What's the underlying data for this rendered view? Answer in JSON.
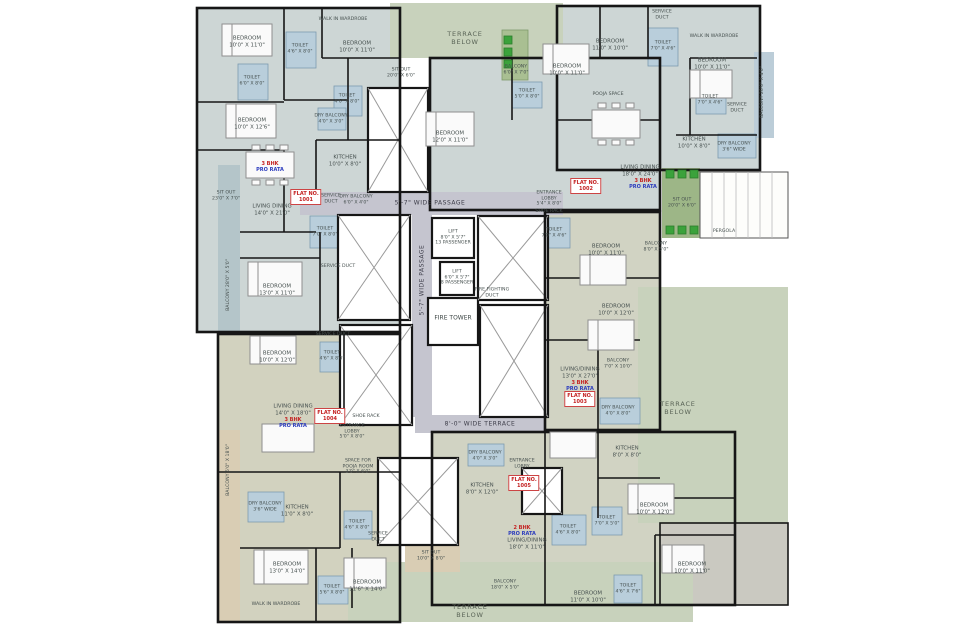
{
  "plan_title": "TYPICAL FLOOR PLAN",
  "colors": {
    "wall": "#161616",
    "apartment_blue": "#cdd6d5",
    "apartment_olive": "#d1d3c3",
    "apartment_beige": "#d2d2bf",
    "terrace_green": "#c8d2bc",
    "sitout_green": "#9db687",
    "balcony_teal": "#b4c5c9",
    "balcony_beige": "#d9cdb4",
    "wet_blue": "#b9cedb",
    "passage_gray": "#c5c5cf",
    "plant_green": "#3ba23b",
    "flat_red": "#c42222",
    "prorata_blue": "#2b3bbd"
  },
  "labels": [
    {
      "n": "passage-top-label",
      "t": "5'-7\" WIDE PASSAGE",
      "x": 430,
      "y": 203,
      "c": "passage"
    },
    {
      "n": "passage-vertical-label",
      "t": "5'-7\" WIDE PASSAGE",
      "x": 422,
      "y": 280,
      "c": "passage vert"
    },
    {
      "n": "terrace-passage-label",
      "t": "8'-0\" WIDE TERRACE",
      "x": 480,
      "y": 424,
      "c": "passage"
    },
    {
      "n": "lift-13-passenger-label",
      "t": "LIFT\n8'0\" X 5'7\"\n13 PASSENGER",
      "x": 453,
      "y": 238,
      "c": "tiny"
    },
    {
      "n": "lift-8-passenger-label",
      "t": "LIFT\n6'0\" X 5'7\"\n8 PASSENGER",
      "x": 457,
      "y": 278,
      "c": "tiny"
    },
    {
      "n": "fire-tower-label",
      "t": "FIRE TOWER",
      "x": 453,
      "y": 318,
      "c": "small"
    },
    {
      "n": "fire-duct-label",
      "t": "FIRE FIGHTING\nDUCT",
      "x": 492,
      "y": 293,
      "c": "tiny"
    },
    {
      "n": "entrance-lobby-right-label",
      "t": "ENTRANCE\nLOBBY\n5'4\" X 8'0\"",
      "x": 549,
      "y": 199,
      "c": "tiny"
    },
    {
      "n": "shoe-rack-right-label",
      "t": "SHOE RACK",
      "x": 549,
      "y": 212,
      "c": "tiny"
    },
    {
      "n": "toilet-core-label",
      "t": "TOILET\n7'0\" X 4'6\"",
      "x": 554,
      "y": 233,
      "c": "tiny"
    },
    {
      "n": "entrance-lobby-left-label",
      "t": "ENTRANCE\nLOBBY\n5'0\" X 8'0\"",
      "x": 352,
      "y": 432,
      "c": "tiny"
    },
    {
      "n": "shoe-rack-left-label",
      "t": "SHOE RACK",
      "x": 366,
      "y": 417,
      "c": "tiny"
    },
    {
      "n": "pooja-room-label",
      "t": "SPACE FOR\nPOOJA ROOM\n3'0\" X 6'0\"",
      "x": 358,
      "y": 467,
      "c": "tiny"
    },
    {
      "n": "bedroom-label",
      "t": "BEDROOM\n10'0\" X 11'0\"",
      "x": 247,
      "y": 42
    },
    {
      "n": "toilet-label",
      "t": "TOILET\n4'6\" X 8'0\"",
      "x": 300,
      "y": 49,
      "c": "tiny"
    },
    {
      "n": "wardrobe-label",
      "t": "WALK IN WARDROBE",
      "x": 343,
      "y": 20,
      "c": "tiny"
    },
    {
      "n": "bedroom-label",
      "t": "BEDROOM\n10'0\" X 11'0\"",
      "x": 357,
      "y": 47
    },
    {
      "n": "sitout-label",
      "t": "SIT OUT\n20'0\" X 6'0\"",
      "x": 401,
      "y": 73,
      "c": "tiny"
    },
    {
      "n": "toilet-label",
      "t": "TOILET\n6'0\" X 8'0\"",
      "x": 252,
      "y": 81,
      "c": "tiny"
    },
    {
      "n": "toilet-label",
      "t": "TOILET\n4'6\" X 8'0\"",
      "x": 347,
      "y": 99,
      "c": "tiny"
    },
    {
      "n": "dry-balcony-label",
      "t": "DRY BALCONY\n4'0\" X 3'0\"",
      "x": 331,
      "y": 119,
      "c": "tiny"
    },
    {
      "n": "bedroom-label",
      "t": "BEDROOM\n10'0\" X 12'6\"",
      "x": 252,
      "y": 124
    },
    {
      "n": "kitchen-label",
      "t": "KITCHEN\n10'0\" X 8'0\"",
      "x": 345,
      "y": 161
    },
    {
      "n": "flat-type-label",
      "t": "3 BHK",
      "x": 270,
      "y": 164,
      "c": "red"
    },
    {
      "n": "pro-rata-label",
      "t": "PRO RATA",
      "x": 270,
      "y": 170,
      "c": "blue"
    },
    {
      "n": "sitout-label",
      "t": "SIT OUT\n23'0\" X 7'0\"",
      "x": 226,
      "y": 196,
      "c": "tiny"
    },
    {
      "n": "living-dining-label",
      "t": "LIVING DINING\n14'0\" X 21'0\"",
      "x": 272,
      "y": 210
    },
    {
      "n": "flat-number-badge",
      "t": "FLAT NO.\n1001",
      "x": 306,
      "y": 197,
      "c": "redbox"
    },
    {
      "n": "service-duct-label",
      "t": "SERVICE\nDUCT",
      "x": 331,
      "y": 199,
      "c": "tiny"
    },
    {
      "n": "dry-balcony-label",
      "t": "DRY BALCONY\n6'0\" X 4'0\"",
      "x": 356,
      "y": 200,
      "c": "tiny"
    },
    {
      "n": "toilet-label",
      "t": "TOILET\n7'0\" X 8'0\"",
      "x": 325,
      "y": 232,
      "c": "tiny"
    },
    {
      "n": "service-duct-label",
      "t": "SERVICE DUCT",
      "x": 338,
      "y": 267,
      "c": "tiny"
    },
    {
      "n": "balcony-label",
      "t": "BALCONY  28'0\" X 5'0\"",
      "x": 229,
      "y": 285,
      "c": "tiny vert"
    },
    {
      "n": "bedroom-label",
      "t": "BEDROOM\n13'0\" X 11'0\"",
      "x": 277,
      "y": 290
    },
    {
      "n": "terrace-below-label",
      "t": "TERRACE\nBELOW",
      "x": 465,
      "y": 38,
      "c": "green-label"
    },
    {
      "n": "bedroom-label",
      "t": "BEDROOM\n12'0\" X 11'0\"",
      "x": 450,
      "y": 137
    },
    {
      "n": "balcony-label",
      "t": "BALCONY\n6'0\" X 7'0\"",
      "x": 516,
      "y": 70,
      "c": "tiny"
    },
    {
      "n": "toilet-label",
      "t": "TOILET\n5'0\" X 8'0\"",
      "x": 527,
      "y": 94,
      "c": "tiny"
    },
    {
      "n": "bedroom-label",
      "t": "BEDROOM\n10'0\" X 11'0\"",
      "x": 567,
      "y": 70
    },
    {
      "n": "bedroom-label",
      "t": "BEDROOM\n11'0\" X 10'0\"",
      "x": 610,
      "y": 45
    },
    {
      "n": "toilet-label",
      "t": "TOILET\n7'0\" X 4'6\"",
      "x": 663,
      "y": 46,
      "c": "tiny"
    },
    {
      "n": "service-duct-label",
      "t": "SERVICE\nDUCT",
      "x": 662,
      "y": 15,
      "c": "tiny"
    },
    {
      "n": "wardrobe-label",
      "t": "WALK IN WARDROBE",
      "x": 714,
      "y": 37,
      "c": "tiny"
    },
    {
      "n": "bedroom-label",
      "t": "BEDROOM\n10'0\" X 11'0\"",
      "x": 712,
      "y": 64
    },
    {
      "n": "toilet-label",
      "t": "TOILET\n7'0\" X 4'6\"",
      "x": 710,
      "y": 100,
      "c": "tiny"
    },
    {
      "n": "service-duct-label",
      "t": "SERVICE\nDUCT",
      "x": 737,
      "y": 108,
      "c": "tiny"
    },
    {
      "n": "balcony-label",
      "t": "BALCONY  20'0\" X 4'0\"",
      "x": 763,
      "y": 92,
      "c": "tiny vert"
    },
    {
      "n": "pooja-space-label",
      "t": "POOJA SPACE",
      "x": 608,
      "y": 95,
      "c": "tiny"
    },
    {
      "n": "kitchen-label",
      "t": "KITCHEN\n10'0\" X 8'0\"",
      "x": 694,
      "y": 143
    },
    {
      "n": "dry-balcony-label",
      "t": "DRY BALCONY\n3'6\" WIDE",
      "x": 734,
      "y": 147,
      "c": "tiny"
    },
    {
      "n": "living-dining-label",
      "t": "LIVING DINING\n18'0\" X 24'0\"",
      "x": 640,
      "y": 171
    },
    {
      "n": "flat-type-label",
      "t": "3 BHK",
      "x": 643,
      "y": 181,
      "c": "red"
    },
    {
      "n": "pro-rata-label",
      "t": "PRO RATA",
      "x": 643,
      "y": 187,
      "c": "blue"
    },
    {
      "n": "flat-number-badge",
      "t": "FLAT NO.\n1002",
      "x": 586,
      "y": 186,
      "c": "redbox"
    },
    {
      "n": "sitout-label",
      "t": "SIT OUT\n20'0\" X 6'0\"",
      "x": 682,
      "y": 203,
      "c": "tiny"
    },
    {
      "n": "pergola-label",
      "t": "PERGOLA",
      "x": 724,
      "y": 232,
      "c": "tiny"
    },
    {
      "n": "bedroom-label",
      "t": "BEDROOM\n10'0\" X 11'0\"",
      "x": 606,
      "y": 250
    },
    {
      "n": "balcony-label",
      "t": "BALCONY\n8'0\" X 5'0\"",
      "x": 656,
      "y": 247,
      "c": "tiny"
    },
    {
      "n": "bedroom-label",
      "t": "BEDROOM\n10'0\" X 12'0\"",
      "x": 616,
      "y": 310
    },
    {
      "n": "balcony-label",
      "t": "BALCONY\n7'0\" X 10'0\"",
      "x": 618,
      "y": 364,
      "c": "tiny"
    },
    {
      "n": "living-dining-label",
      "t": "LIVING/DINING\n13'0\" X 27'0\"",
      "x": 580,
      "y": 373
    },
    {
      "n": "flat-type-label",
      "t": "3 BHK",
      "x": 580,
      "y": 383,
      "c": "red"
    },
    {
      "n": "pro-rata-label",
      "t": "PRO RATA",
      "x": 580,
      "y": 389,
      "c": "blue"
    },
    {
      "n": "flat-number-badge",
      "t": "FLAT NO.\n1003",
      "x": 580,
      "y": 399,
      "c": "redbox"
    },
    {
      "n": "dry-balcony-label",
      "t": "DRY BALCONY\n4'0\" X 8'0\"",
      "x": 618,
      "y": 411,
      "c": "tiny"
    },
    {
      "n": "terrace-below-label",
      "t": "TERRACE\nBELOW",
      "x": 678,
      "y": 408,
      "c": "green-label"
    },
    {
      "n": "kitchen-label",
      "t": "KITCHEN\n8'0\" X 8'0\"",
      "x": 627,
      "y": 452
    },
    {
      "n": "bedroom-label",
      "t": "BEDROOM\n10'0\" X 12'0\"",
      "x": 654,
      "y": 509
    },
    {
      "n": "toilet-label",
      "t": "TOILET\n7'0\" X 5'0\"",
      "x": 607,
      "y": 521,
      "c": "tiny"
    },
    {
      "n": "bedroom-label",
      "t": "BEDROOM\n10'0\" X 11'0\"",
      "x": 692,
      "y": 568
    },
    {
      "n": "toilet-label",
      "t": "TOILET\n4'6\" X 7'6\"",
      "x": 628,
      "y": 589,
      "c": "tiny"
    },
    {
      "n": "bedroom-label",
      "t": "BEDROOM\n11'0\" X 10'0\"",
      "x": 588,
      "y": 597
    },
    {
      "n": "dry-balcony-label",
      "t": "DRY BALCONY\n4'0\" X 3'0\"",
      "x": 485,
      "y": 456,
      "c": "tiny"
    },
    {
      "n": "kitchen-label",
      "t": "KITCHEN\n8'0\" X 12'0\"",
      "x": 482,
      "y": 489
    },
    {
      "n": "entrance-lobby-label",
      "t": "ENTRANCE\nLOBBY",
      "x": 522,
      "y": 464,
      "c": "tiny"
    },
    {
      "n": "flat-number-badge",
      "t": "FLAT NO.\n1005",
      "x": 524,
      "y": 483,
      "c": "redbox"
    },
    {
      "n": "flat-type-label",
      "t": "2 BHK",
      "x": 522,
      "y": 528,
      "c": "red"
    },
    {
      "n": "pro-rata-label",
      "t": "PRO RATA",
      "x": 522,
      "y": 534,
      "c": "blue"
    },
    {
      "n": "living-dining-label",
      "t": "LIVING/DINING\n18'0\" X 11'0\"",
      "x": 527,
      "y": 544
    },
    {
      "n": "toilet-label",
      "t": "TOILET\n4'6\" X 8'0\"",
      "x": 568,
      "y": 530,
      "c": "tiny"
    },
    {
      "n": "sitout-label",
      "t": "SIT OUT\n10'0\" X 8'0\"",
      "x": 431,
      "y": 556,
      "c": "tiny"
    },
    {
      "n": "balcony-label",
      "t": "BALCONY\n18'0\" X 5'0\"",
      "x": 505,
      "y": 585,
      "c": "tiny"
    },
    {
      "n": "terrace-below-label",
      "t": "TERRACE\nBELOW",
      "x": 470,
      "y": 611,
      "c": "green-label"
    },
    {
      "n": "bedroom-label",
      "t": "BEDROOM\n10'0\" X 12'0\"",
      "x": 277,
      "y": 357
    },
    {
      "n": "toilet-label",
      "t": "TOILET\n4'6\" X 8'0\"",
      "x": 332,
      "y": 356,
      "c": "tiny"
    },
    {
      "n": "service-duct-label",
      "t": "SERVICE DUCT",
      "x": 333,
      "y": 335,
      "c": "tiny"
    },
    {
      "n": "living-dining-label",
      "t": "LIVING DINING\n14'0\" X 18'0\"",
      "x": 293,
      "y": 410
    },
    {
      "n": "flat-type-label",
      "t": "3 BHK",
      "x": 293,
      "y": 420,
      "c": "red"
    },
    {
      "n": "pro-rata-label",
      "t": "PRO RATA",
      "x": 293,
      "y": 426,
      "c": "blue"
    },
    {
      "n": "flat-number-badge",
      "t": "FLAT NO.\n1004",
      "x": 330,
      "y": 416,
      "c": "redbox"
    },
    {
      "n": "balcony-label",
      "t": "BALCONY  5'0\" X 18'0\"",
      "x": 229,
      "y": 470,
      "c": "tiny vert"
    },
    {
      "n": "dry-balcony-label",
      "t": "DRY BALCONY\n3'6\" WIDE",
      "x": 265,
      "y": 507,
      "c": "tiny"
    },
    {
      "n": "kitchen-label",
      "t": "KITCHEN\n11'0\" X 8'0\"",
      "x": 297,
      "y": 511
    },
    {
      "n": "toilet-label",
      "t": "TOILET\n4'6\" X 8'0\"",
      "x": 357,
      "y": 525,
      "c": "tiny"
    },
    {
      "n": "service-duct-label",
      "t": "SERVICE\nDUCT",
      "x": 378,
      "y": 537,
      "c": "tiny"
    },
    {
      "n": "bedroom-label",
      "t": "BEDROOM\n13'0\" X 14'0\"",
      "x": 287,
      "y": 568
    },
    {
      "n": "wardrobe-label",
      "t": "WALK IN WARDROBE",
      "x": 276,
      "y": 605,
      "c": "tiny"
    },
    {
      "n": "toilet-label",
      "t": "TOILET\n5'6\" X 8'0\"",
      "x": 332,
      "y": 590,
      "c": "tiny"
    },
    {
      "n": "bedroom-label",
      "t": "BEDROOM\n11'6\" X 14'0\"",
      "x": 367,
      "y": 586
    }
  ]
}
